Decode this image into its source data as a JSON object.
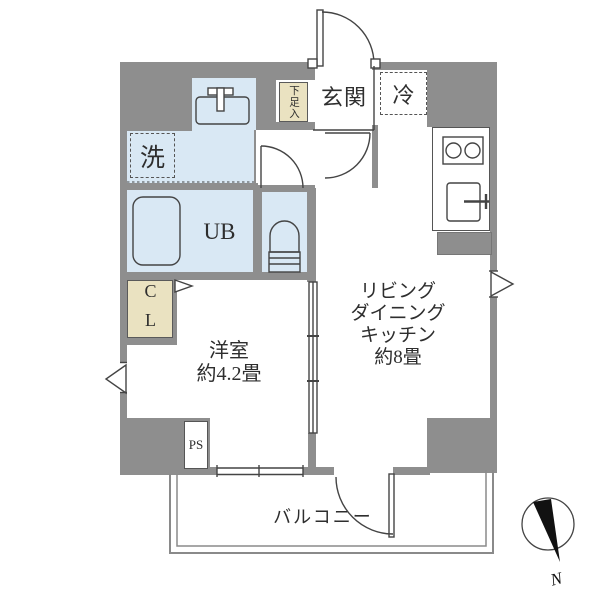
{
  "floorplan": {
    "rooms": {
      "genkan": {
        "label": "玄関"
      },
      "fridge": {
        "label": "冷"
      },
      "washer": {
        "label": "洗"
      },
      "shoe_cabinet": {
        "label": "下足入"
      },
      "unit_bath": {
        "label": "UB"
      },
      "closet": {
        "label": "CL"
      },
      "western_room": {
        "name": "洋室",
        "size": "約4.2畳"
      },
      "ldk": {
        "line1": "リビング",
        "line2": "ダイニング",
        "line3": "キッチン",
        "size": "約8畳"
      },
      "pipe_space": {
        "label": "PS"
      },
      "balcony": {
        "label": "バルコニー"
      }
    },
    "compass": {
      "north_label": "N"
    },
    "colors": {
      "wall_gray": "#8e8e8e",
      "water_blue": "#d9e8f4",
      "storage_beige": "#eae2c1",
      "line_dark": "#444444",
      "compass_black": "#111111"
    }
  }
}
